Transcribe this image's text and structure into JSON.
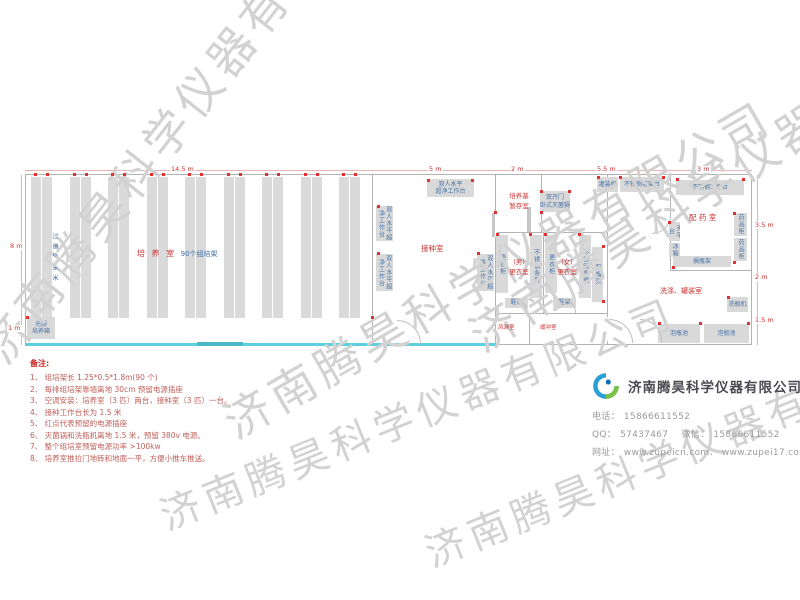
{
  "watermark": {
    "text": "济南腾昊科学仪器有限公司"
  },
  "plan": {
    "watermarks": [
      {
        "x": -35,
        "y": 335,
        "rot": -52,
        "size": 46
      },
      {
        "x": 210,
        "y": 395,
        "rot": -30,
        "size": 46
      },
      {
        "x": 455,
        "y": 310,
        "rot": -33,
        "size": 46
      },
      {
        "x": 150,
        "y": 488,
        "rot": -22,
        "size": 40
      },
      {
        "x": 415,
        "y": 525,
        "rot": -22,
        "size": 40
      }
    ],
    "culture_room": {
      "label_red": "培 养 室 ",
      "label_blue": "90个组培架",
      "aisle_label": "过道0.6米"
    },
    "racks": {
      "count": 9,
      "x0": 31,
      "pitch": 38.5,
      "w": 21,
      "y": 177,
      "h": 141
    },
    "equipment": [
      {
        "n": "clean-bench-top",
        "label": "双人水平\n超净工作台",
        "x": 427,
        "y": 179,
        "w": 47,
        "h": 18,
        "v": false
      },
      {
        "n": "clean-bench-left-1",
        "label": "双人水平超净工作台",
        "x": 376,
        "y": 206,
        "w": 17,
        "h": 35,
        "v": true
      },
      {
        "n": "clean-bench-left-2",
        "label": "双人水平超净工作台",
        "x": 376,
        "y": 254,
        "w": 17,
        "h": 37,
        "v": true
      },
      {
        "n": "clean-bench-right",
        "label": "双人水平超净工作台",
        "x": 477,
        "y": 254,
        "w": 17,
        "h": 37,
        "v": true
      },
      {
        "n": "autoclave",
        "label": "双开门\n卧式灭菌锅",
        "x": 540,
        "y": 191,
        "w": 30,
        "h": 21,
        "v": false
      },
      {
        "n": "locker-1",
        "label": "更衣柜",
        "x": 496,
        "y": 235,
        "w": 12,
        "h": 58,
        "v": true
      },
      {
        "n": "steel-bench-1",
        "label": "不锈钢条凳",
        "x": 530,
        "y": 235,
        "w": 12,
        "h": 63,
        "v": true
      },
      {
        "n": "locker-2",
        "label": "更衣柜",
        "x": 545,
        "y": 235,
        "w": 12,
        "h": 58,
        "v": true
      },
      {
        "n": "steel-bench-2",
        "label": "不锈钢条凳",
        "x": 579,
        "y": 235,
        "w": 12,
        "h": 63,
        "v": true
      },
      {
        "n": "shoe-hat-rack",
        "label": "鞋帽架",
        "x": 592,
        "y": 247,
        "w": 11,
        "h": 55,
        "v": true
      },
      {
        "n": "shoe-rack-1",
        "label": "鞋架",
        "x": 505,
        "y": 298,
        "w": 23,
        "h": 10,
        "v": false
      },
      {
        "n": "shoe-rack-2",
        "label": "鞋架",
        "x": 553,
        "y": 298,
        "w": 23,
        "h": 10,
        "v": false
      },
      {
        "n": "filling-machine",
        "label": "灌装机",
        "x": 597,
        "y": 177,
        "w": 21,
        "h": 15,
        "v": false
      },
      {
        "n": "steel-filling-table",
        "label": "不锈钢灌装台",
        "x": 620,
        "y": 177,
        "w": 44,
        "h": 15,
        "v": false
      },
      {
        "n": "steel-worktable",
        "label": "不锈钢工作台",
        "x": 676,
        "y": 180,
        "w": 68,
        "h": 15,
        "v": false
      },
      {
        "n": "medicine-cabinet-1",
        "label": "药品柜",
        "x": 734,
        "y": 213,
        "w": 13,
        "h": 23,
        "v": true
      },
      {
        "n": "medicine-cabinet-2",
        "label": "药品柜",
        "x": 734,
        "y": 238,
        "w": 13,
        "h": 23,
        "v": true
      },
      {
        "n": "balance-table",
        "label": "天平台",
        "x": 669,
        "y": 222,
        "w": 11,
        "h": 19,
        "v": true
      },
      {
        "n": "fridge",
        "label": "冰箱",
        "x": 669,
        "y": 243,
        "w": 11,
        "h": 14,
        "v": true
      },
      {
        "n": "bottle-shelf",
        "label": "搁瓶架",
        "x": 673,
        "y": 256,
        "w": 58,
        "h": 11,
        "v": false
      },
      {
        "n": "bottle-washer",
        "label": "洗瓶机",
        "x": 727,
        "y": 297,
        "w": 21,
        "h": 15,
        "v": false
      },
      {
        "n": "soak-pool-1",
        "label": "泡瓶池",
        "x": 658,
        "y": 324,
        "w": 42,
        "h": 19,
        "v": false
      },
      {
        "n": "soak-pool-2",
        "label": "泡瓶池",
        "x": 704,
        "y": 324,
        "w": 45,
        "h": 19,
        "v": false
      },
      {
        "n": "light-incubator",
        "label": "光照\n培养箱",
        "x": 27,
        "y": 317,
        "w": 28,
        "h": 22,
        "v": false
      }
    ],
    "room_labels": [
      {
        "n": "inoculation-room",
        "label": "接种室",
        "x": 421,
        "y": 243,
        "fs": 7.5
      },
      {
        "n": "medium-storage-room",
        "label": "培养基\n暂存室",
        "x": 498,
        "y": 191,
        "fs": 6.5,
        "w": 42
      },
      {
        "n": "male-changing-room",
        "label": "(男)\n更衣室",
        "x": 504,
        "y": 257,
        "fs": 6.5,
        "w": 30
      },
      {
        "n": "female-changing-room",
        "label": "(女)\n更衣室",
        "x": 552,
        "y": 257,
        "fs": 6.5,
        "w": 30
      },
      {
        "n": "air-shower-room",
        "label": "风淋室",
        "x": 498,
        "y": 324,
        "fs": 5.5
      },
      {
        "n": "buffer-room",
        "label": "缓冲室",
        "x": 540,
        "y": 324,
        "fs": 5.5
      },
      {
        "n": "preparation-room",
        "label": "配 药 室",
        "x": 689,
        "y": 212,
        "fs": 7.5
      },
      {
        "n": "washing-filling-room",
        "label": "洗涤、罐装室",
        "x": 660,
        "y": 286,
        "fs": 7
      }
    ],
    "dimensions": [
      {
        "label": "14.5 m",
        "x": 170,
        "y": 166
      },
      {
        "label": "5 m",
        "x": 428,
        "y": 166
      },
      {
        "label": "2 m",
        "x": 510,
        "y": 166
      },
      {
        "label": "5.5 m",
        "x": 596,
        "y": 166
      },
      {
        "label": "3 m",
        "x": 696,
        "y": 166
      },
      {
        "label": "8 m",
        "x": 9,
        "y": 243
      },
      {
        "label": "1 m",
        "x": 7,
        "y": 325
      },
      {
        "label": "3.5 m",
        "x": 754,
        "y": 222
      },
      {
        "label": "2 m",
        "x": 754,
        "y": 274
      },
      {
        "label": "1.5 m",
        "x": 754,
        "y": 317
      }
    ],
    "outlets": [
      [
        377,
        205
      ],
      [
        377,
        252
      ],
      [
        477,
        252
      ],
      [
        427,
        179
      ],
      [
        471,
        179
      ],
      [
        540,
        190
      ],
      [
        568,
        190
      ],
      [
        496,
        233
      ],
      [
        529,
        233
      ],
      [
        544,
        233
      ],
      [
        578,
        233
      ],
      [
        597,
        176
      ],
      [
        619,
        176
      ],
      [
        662,
        176
      ],
      [
        676,
        178
      ],
      [
        742,
        178
      ],
      [
        733,
        212
      ],
      [
        733,
        261
      ],
      [
        668,
        221
      ],
      [
        672,
        266
      ],
      [
        727,
        296
      ],
      [
        658,
        322
      ],
      [
        699,
        322
      ],
      [
        747,
        322
      ],
      [
        26,
        316
      ],
      [
        371,
        316
      ],
      [
        494,
        211
      ],
      [
        540,
        211
      ],
      [
        602,
        245
      ],
      [
        602,
        300
      ]
    ],
    "arcs": [
      {
        "x": 397,
        "y": 320,
        "s": 23,
        "t": "tr"
      },
      {
        "x": 609,
        "y": 319,
        "s": 23,
        "t": "tr"
      },
      {
        "x": 640,
        "y": 319,
        "s": 21,
        "t": "tr"
      },
      {
        "x": 513,
        "y": 298,
        "s": 14,
        "t": "tr"
      },
      {
        "x": 561,
        "y": 298,
        "s": 14,
        "t": "tr"
      },
      {
        "x": 652,
        "y": 215,
        "s": 18,
        "t": "br"
      }
    ]
  },
  "notes": {
    "title": "备注:",
    "items": [
      "1、 组培架长 1.25*0.5*1.8m(90 个)",
      "2、 每排组培架靠墙离地 30cm 预留电源插座",
      "3、 空调安装：培养室（3 匹）两台，接种室（3 匹）一台。",
      "4、 接种工作台长为 1.5 米",
      "5、 红点代表预留的电源插座",
      "6、 灭菌锅和洗瓶机离地 1.5 米，预留 380v 电源。",
      "7、 整个组培室预留电源功率 >100kw",
      "8、 培养室推拉门地砖和地面一平，方便小推车推送。"
    ]
  },
  "company": {
    "name": "济南腾昊科学仪器有限公司",
    "phone_label": "电话：",
    "phone": "15866611552",
    "qq_label": "QQ：",
    "qq": "57437467",
    "wechat_label": "微信：",
    "wechat": "15866611552",
    "web_label": "网址：",
    "websites": "www.zupeicn.com、 www.zupei17.com"
  }
}
